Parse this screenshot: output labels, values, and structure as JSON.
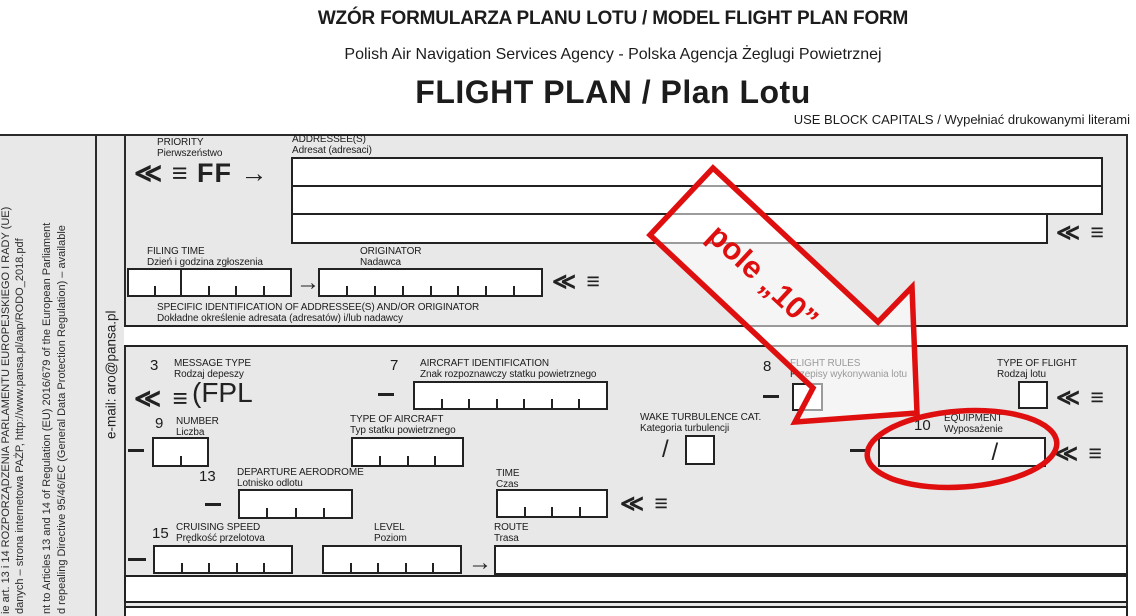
{
  "header": {
    "title_line1": "WZÓR FORMULARZA PLANU LOTU / MODEL FLIGHT PLAN FORM",
    "title_line2": "Polish Air Navigation Services Agency - Polska Agencja Żeglugi Powietrznej",
    "title_line3": "FLIGHT PLAN / Plan Lotu",
    "caps_note": "USE BLOCK CAPITALS / Wypełniać drukowanymi literami"
  },
  "sidebar": {
    "rodo_lines": [
      "ie art. 13 i 14 ROZPORZĄDZENIA PARLAMENTU EUROPEJSKIEGO I RADY (UE)",
      "danych – strona internetowa PAŻP, http://www.pansa.pl/aap/RODO_2018.pdf",
      "nt to Articles 13 and 14 of Regulation (EU) 2016/679 of the European Parliament",
      "d repealing Directive 95/46/EC (General Data Protection Regulation) – available"
    ],
    "email": "e-mail: aro@pansa.pl"
  },
  "marks": {
    "telex": "≪ ≡",
    "priority_mark": "≪ ≡ FF →",
    "fpl_prefix": "(FPL",
    "arrow_right": "→",
    "slash": "/"
  },
  "fields": {
    "priority": {
      "en": "PRIORITY",
      "pl": "Pierwszeństwo"
    },
    "addressee": {
      "en": "ADDRESSEE(S)",
      "pl": "Adresat (adresaci)"
    },
    "filing_time": {
      "en": "FILING TIME",
      "pl": "Dzień  i godzina zgłoszenia"
    },
    "originator": {
      "en": "ORIGINATOR",
      "pl": "Nadawca"
    },
    "specific_identification": {
      "en": "SPECIFIC IDENTIFICATION OF ADDRESSEE(S) AND/OR ORIGINATOR",
      "pl": "Dokładne określenie adresata (adresatów) i/lub nadawcy"
    },
    "message_type": {
      "num": "3",
      "en": "MESSAGE TYPE",
      "pl": "Rodzaj depeszy"
    },
    "aircraft_identification": {
      "num": "7",
      "en": "AIRCRAFT IDENTIFICATION",
      "pl": "Znak rozpoznawczy statku powietrznego"
    },
    "flight_rules": {
      "num": "8",
      "en": "FLIGHT RULES",
      "pl": "Przepisy wykonywania lotu"
    },
    "type_of_flight": {
      "en": "TYPE OF FLIGHT",
      "pl": "Rodzaj lotu"
    },
    "number": {
      "num": "9",
      "en": "NUMBER",
      "pl": "Liczba"
    },
    "type_of_aircraft": {
      "en": "TYPE OF AIRCRAFT",
      "pl": "Typ statku powietrznego"
    },
    "wake_turbulence": {
      "en": "WAKE TURBULENCE CAT.",
      "pl": "Kategoria turbulencji"
    },
    "equipment": {
      "num": "10",
      "en": "EQUIPMENT",
      "pl": "Wyposażenie"
    },
    "departure_aerodrome": {
      "num": "13",
      "en": "DEPARTURE AERODROME",
      "pl": "Lotnisko odlotu"
    },
    "time": {
      "en": "TIME",
      "pl": "Czas"
    },
    "cruising_speed": {
      "num": "15",
      "en": "CRUISING SPEED",
      "pl": "Prędkość przelotova"
    },
    "level": {
      "en": "LEVEL",
      "pl": "Poziom"
    },
    "route": {
      "en": "ROUTE",
      "pl": "Trasa"
    }
  },
  "annotation": {
    "label": "pole „10”",
    "color": "#df0f0f"
  }
}
